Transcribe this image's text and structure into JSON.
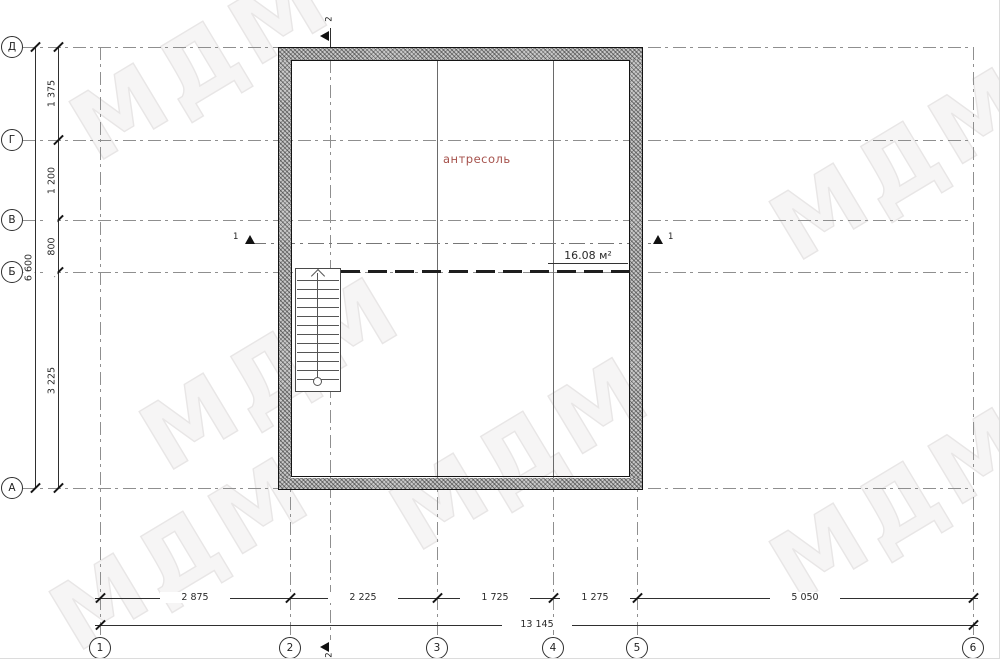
{
  "watermark": {
    "text": "МДМ"
  },
  "plan": {
    "room_label": "антресоль",
    "area_label": "16.08 м²"
  },
  "grid": {
    "rows": [
      "Д",
      "Г",
      "В",
      "Б",
      "А"
    ],
    "cols": [
      "1",
      "2",
      "3",
      "4",
      "5",
      "6"
    ]
  },
  "dims": {
    "left": {
      "segments": [
        "1 375",
        "1 200",
        "800",
        "3 225"
      ],
      "total": "6 600"
    },
    "bottom": {
      "segments": [
        "2 875",
        "2 225",
        "1 725",
        "1 275",
        "5 050"
      ],
      "total": "13 145"
    }
  },
  "sections": {
    "cut_horizontal": "1",
    "cut_vertical": "2"
  },
  "colors": {
    "room_label": "#a6524c",
    "line": "#2f2f2f",
    "grid": "#8f8f8f",
    "wall_border": "#141414",
    "watermark": "#ececec"
  }
}
